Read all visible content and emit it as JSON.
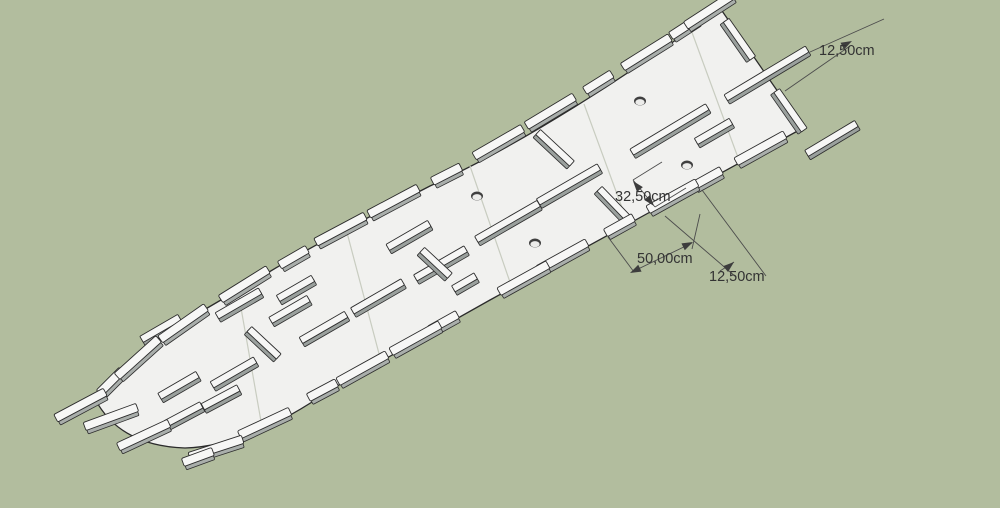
{
  "colors": {
    "background": "#b2bd9e",
    "panel": "#f1f1ef",
    "panel_edge": "#2b2b2b",
    "tab_face": "#f7f7f6",
    "tab_side": "#a9aeab",
    "dimension_line": "#4c4c4c",
    "dimension_text": "#333333"
  },
  "dimensions": {
    "end_tab_length": {
      "label": "12,50cm"
    },
    "slot_offset": {
      "label": "32,50cm"
    },
    "tab_spacing": {
      "label": "50,00cm"
    },
    "edge_tab_length": {
      "label": "12,50cm"
    }
  }
}
